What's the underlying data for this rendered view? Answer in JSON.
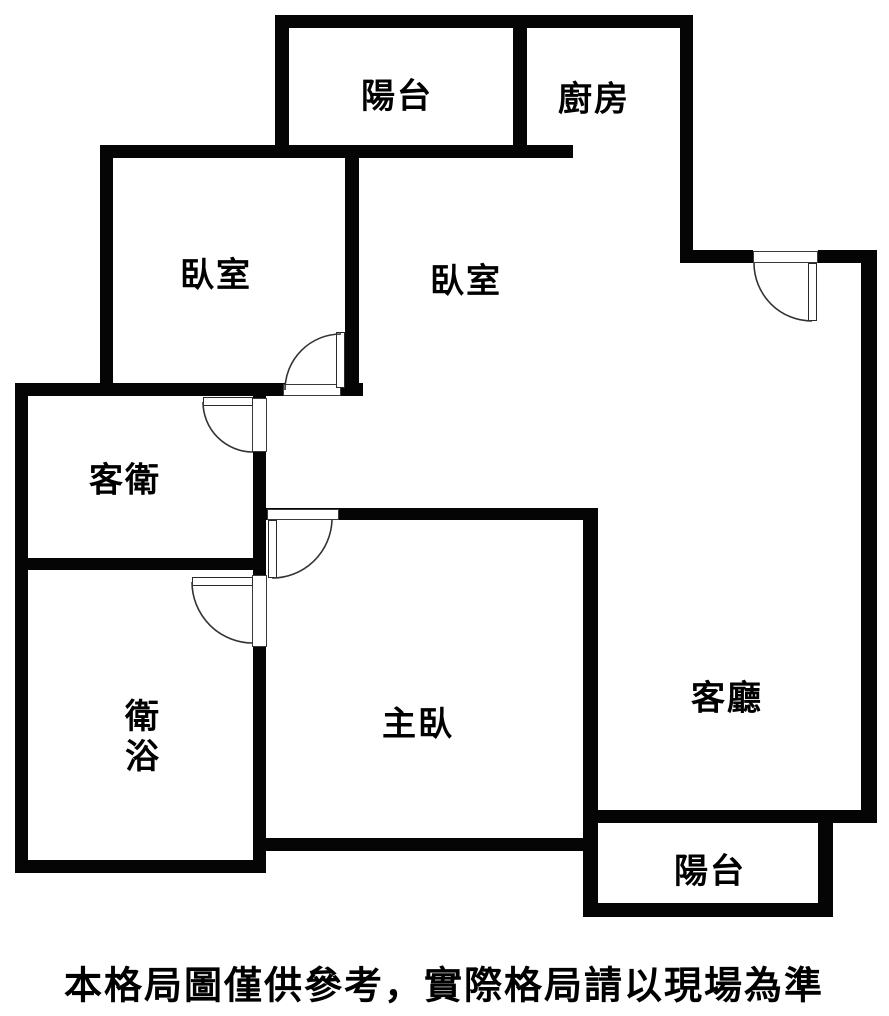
{
  "floorplan": {
    "type": "apartment-floor-plan",
    "rooms": {
      "balcony_top": {
        "label": "陽台"
      },
      "kitchen": {
        "label": "廚房"
      },
      "bedroom_left": {
        "label": "臥室"
      },
      "bedroom_middle": {
        "label": "臥室"
      },
      "guest_bath": {
        "label": "客衛"
      },
      "bath": {
        "label_line1": "衛",
        "label_line2": "浴"
      },
      "master_bedroom": {
        "label": "主臥"
      },
      "living_room": {
        "label": "客廳"
      },
      "balcony_bottom": {
        "label": "陽台"
      }
    },
    "disclaimer": "本格局圖僅供參考，實際格局請以現場為準",
    "colors": {
      "wall": "#050505",
      "background": "#ffffff",
      "text": "#000000",
      "door_line": "#333333"
    }
  }
}
